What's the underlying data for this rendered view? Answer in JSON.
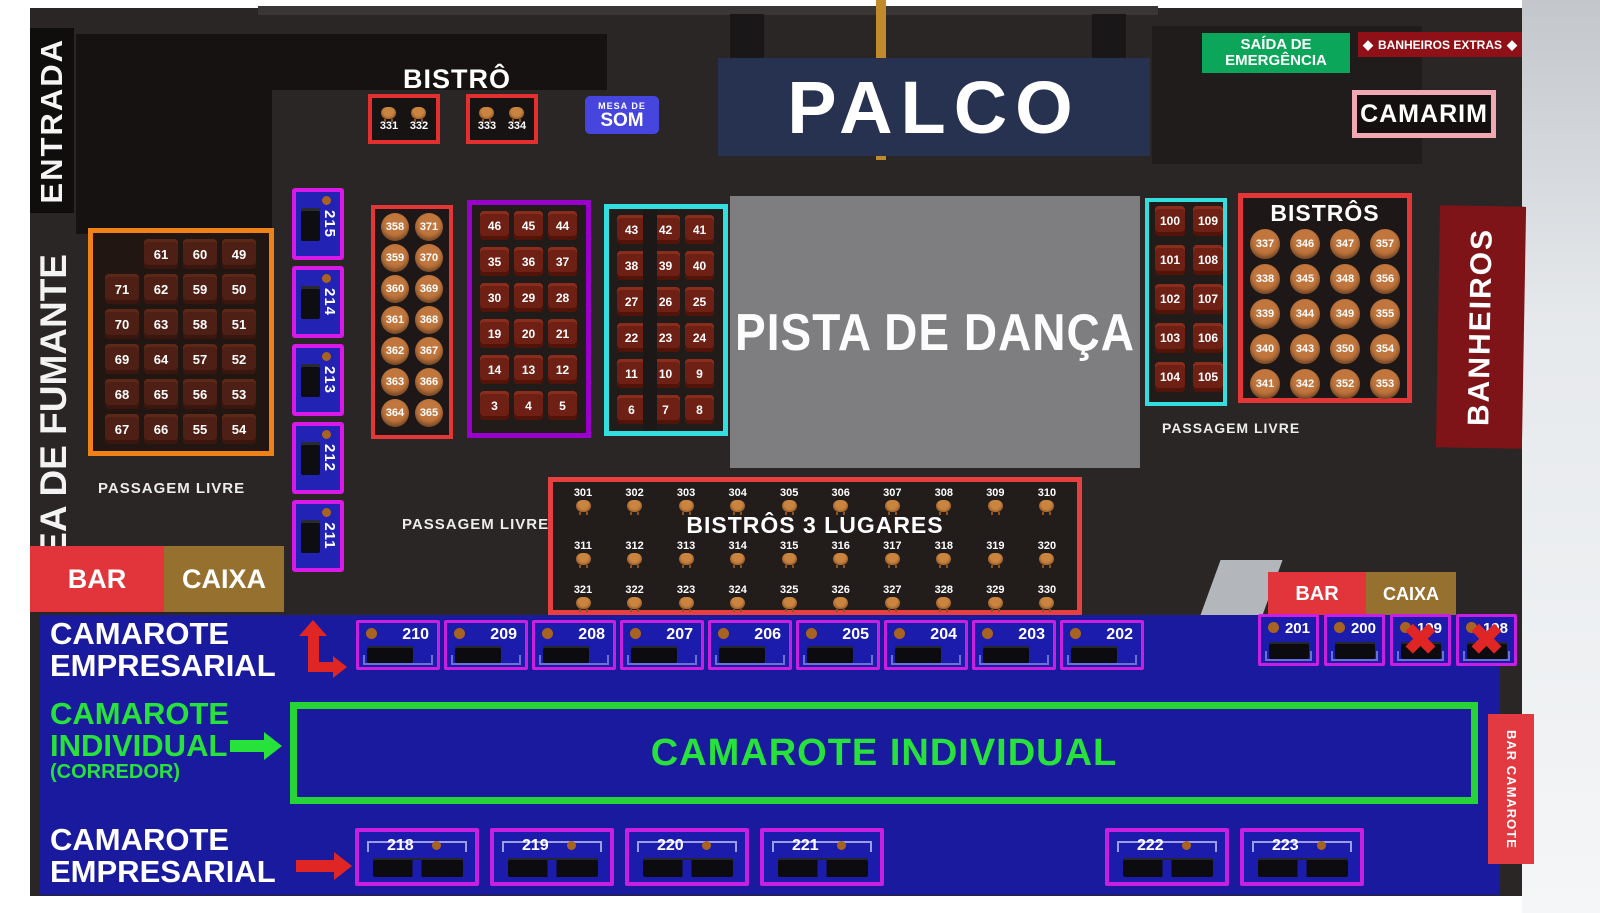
{
  "zones": {
    "entrada": "ENTRADA",
    "area_fumante": "ÁREA DE FUMANTE",
    "bistro": "BISTRÔ",
    "mesa_de_som": {
      "line1": "MESA DE",
      "line2": "SOM"
    },
    "palco": "PALCO",
    "saida": {
      "line1": "SAÍDA DE",
      "line2": "EMERGÊNCIA"
    },
    "banheiros_extras": "BANHEIROS EXTRAS",
    "camarim": "CAMARIM",
    "pista": "PISTA DE DANÇA",
    "bistros": "BISTRÔS",
    "banheiros": "BANHEIROS",
    "bistros_3_lugares": "BISTRÔS 3 LUGARES",
    "passagem_livre": "PASSAGEM LIVRE",
    "bar": "BAR",
    "caixa": "CAIXA",
    "camarote_empresarial": {
      "line1": "CAMAROTE",
      "line2": "EMPRESARIAL"
    },
    "camarote_individual": {
      "line1": "CAMAROTE",
      "line2": "INDIVIDUAL",
      "line3": "(CORREDOR)"
    },
    "camarote_individual_box": "CAMAROTE INDIVIDUAL",
    "bar_camarote": {
      "line1": "BAR",
      "line2": "CAMAROTE"
    }
  },
  "icons": {
    "x_mark": "✖",
    "diamond": "◆"
  },
  "tables": {
    "bistro_top": [
      [
        "331",
        "332"
      ],
      [
        "333",
        "334"
      ]
    ],
    "smoking": [
      [
        "",
        "61",
        "60",
        "49"
      ],
      [
        "71",
        "62",
        "59",
        "50"
      ],
      [
        "70",
        "63",
        "58",
        "51"
      ],
      [
        "69",
        "64",
        "57",
        "52"
      ],
      [
        "68",
        "65",
        "56",
        "53"
      ],
      [
        "67",
        "66",
        "55",
        "54"
      ]
    ],
    "blue_column": [
      "215",
      "214",
      "213",
      "212",
      "211"
    ],
    "round_left": [
      [
        "358",
        "371"
      ],
      [
        "359",
        "370"
      ],
      [
        "360",
        "369"
      ],
      [
        "361",
        "368"
      ],
      [
        "362",
        "367"
      ],
      [
        "363",
        "366"
      ],
      [
        "364",
        "365"
      ]
    ],
    "purple_grid": [
      [
        "46",
        "45",
        "44"
      ],
      [
        "35",
        "36",
        "37"
      ],
      [
        "30",
        "29",
        "28"
      ],
      [
        "19",
        "20",
        "21"
      ],
      [
        "14",
        "13",
        "12"
      ],
      [
        "3",
        "4",
        "5"
      ]
    ],
    "cyan_grid": [
      [
        "43",
        "42",
        "41"
      ],
      [
        "38",
        "39",
        "40"
      ],
      [
        "27",
        "26",
        "25"
      ],
      [
        "22",
        "23",
        "24"
      ],
      [
        "11",
        "10",
        "9"
      ],
      [
        "6",
        "7",
        "8"
      ]
    ],
    "cyan_right": [
      [
        "100",
        "109"
      ],
      [
        "101",
        "108"
      ],
      [
        "102",
        "107"
      ],
      [
        "103",
        "106"
      ],
      [
        "104",
        "105"
      ]
    ],
    "bistros_right": [
      [
        "337",
        "346",
        "347",
        "357"
      ],
      [
        "338",
        "345",
        "348",
        "356"
      ],
      [
        "339",
        "344",
        "349",
        "355"
      ],
      [
        "340",
        "343",
        "350",
        "354"
      ],
      [
        "341",
        "342",
        "352",
        "353"
      ]
    ],
    "bistros3_rows": [
      [
        "301",
        "302",
        "303",
        "304",
        "305",
        "306",
        "307",
        "308",
        "309",
        "310"
      ],
      [
        "311",
        "312",
        "313",
        "314",
        "315",
        "316",
        "317",
        "318",
        "319",
        "320"
      ],
      [
        "321",
        "322",
        "323",
        "324",
        "325",
        "326",
        "327",
        "328",
        "329",
        "330"
      ]
    ],
    "camarote_top": [
      "210",
      "209",
      "208",
      "207",
      "206",
      "205",
      "204",
      "203",
      "202"
    ],
    "camarote_right": [
      {
        "label": "201",
        "crossed": false
      },
      {
        "label": "200",
        "crossed": false
      },
      {
        "label": "199",
        "crossed": true
      },
      {
        "label": "198",
        "crossed": true
      }
    ],
    "camarote_bottom": [
      "218",
      "219",
      "220",
      "221",
      "222",
      "223"
    ]
  },
  "colors": {
    "orange_border": "#f08018",
    "red_border": "#e33636",
    "purple_border": "#9900cc",
    "magenta_border": "#d819e8",
    "cyan_border": "#35dede",
    "green_border": "#26d437",
    "blue_band": "#1a1a9e",
    "emergency_green": "#0ca65a",
    "banheiros_dark_red": "#7e1418",
    "bar_red": "#e2353b",
    "caixa_brown": "#96702f",
    "table_brown": "#c1763d",
    "camarim_pink": "#f0a8b2"
  }
}
